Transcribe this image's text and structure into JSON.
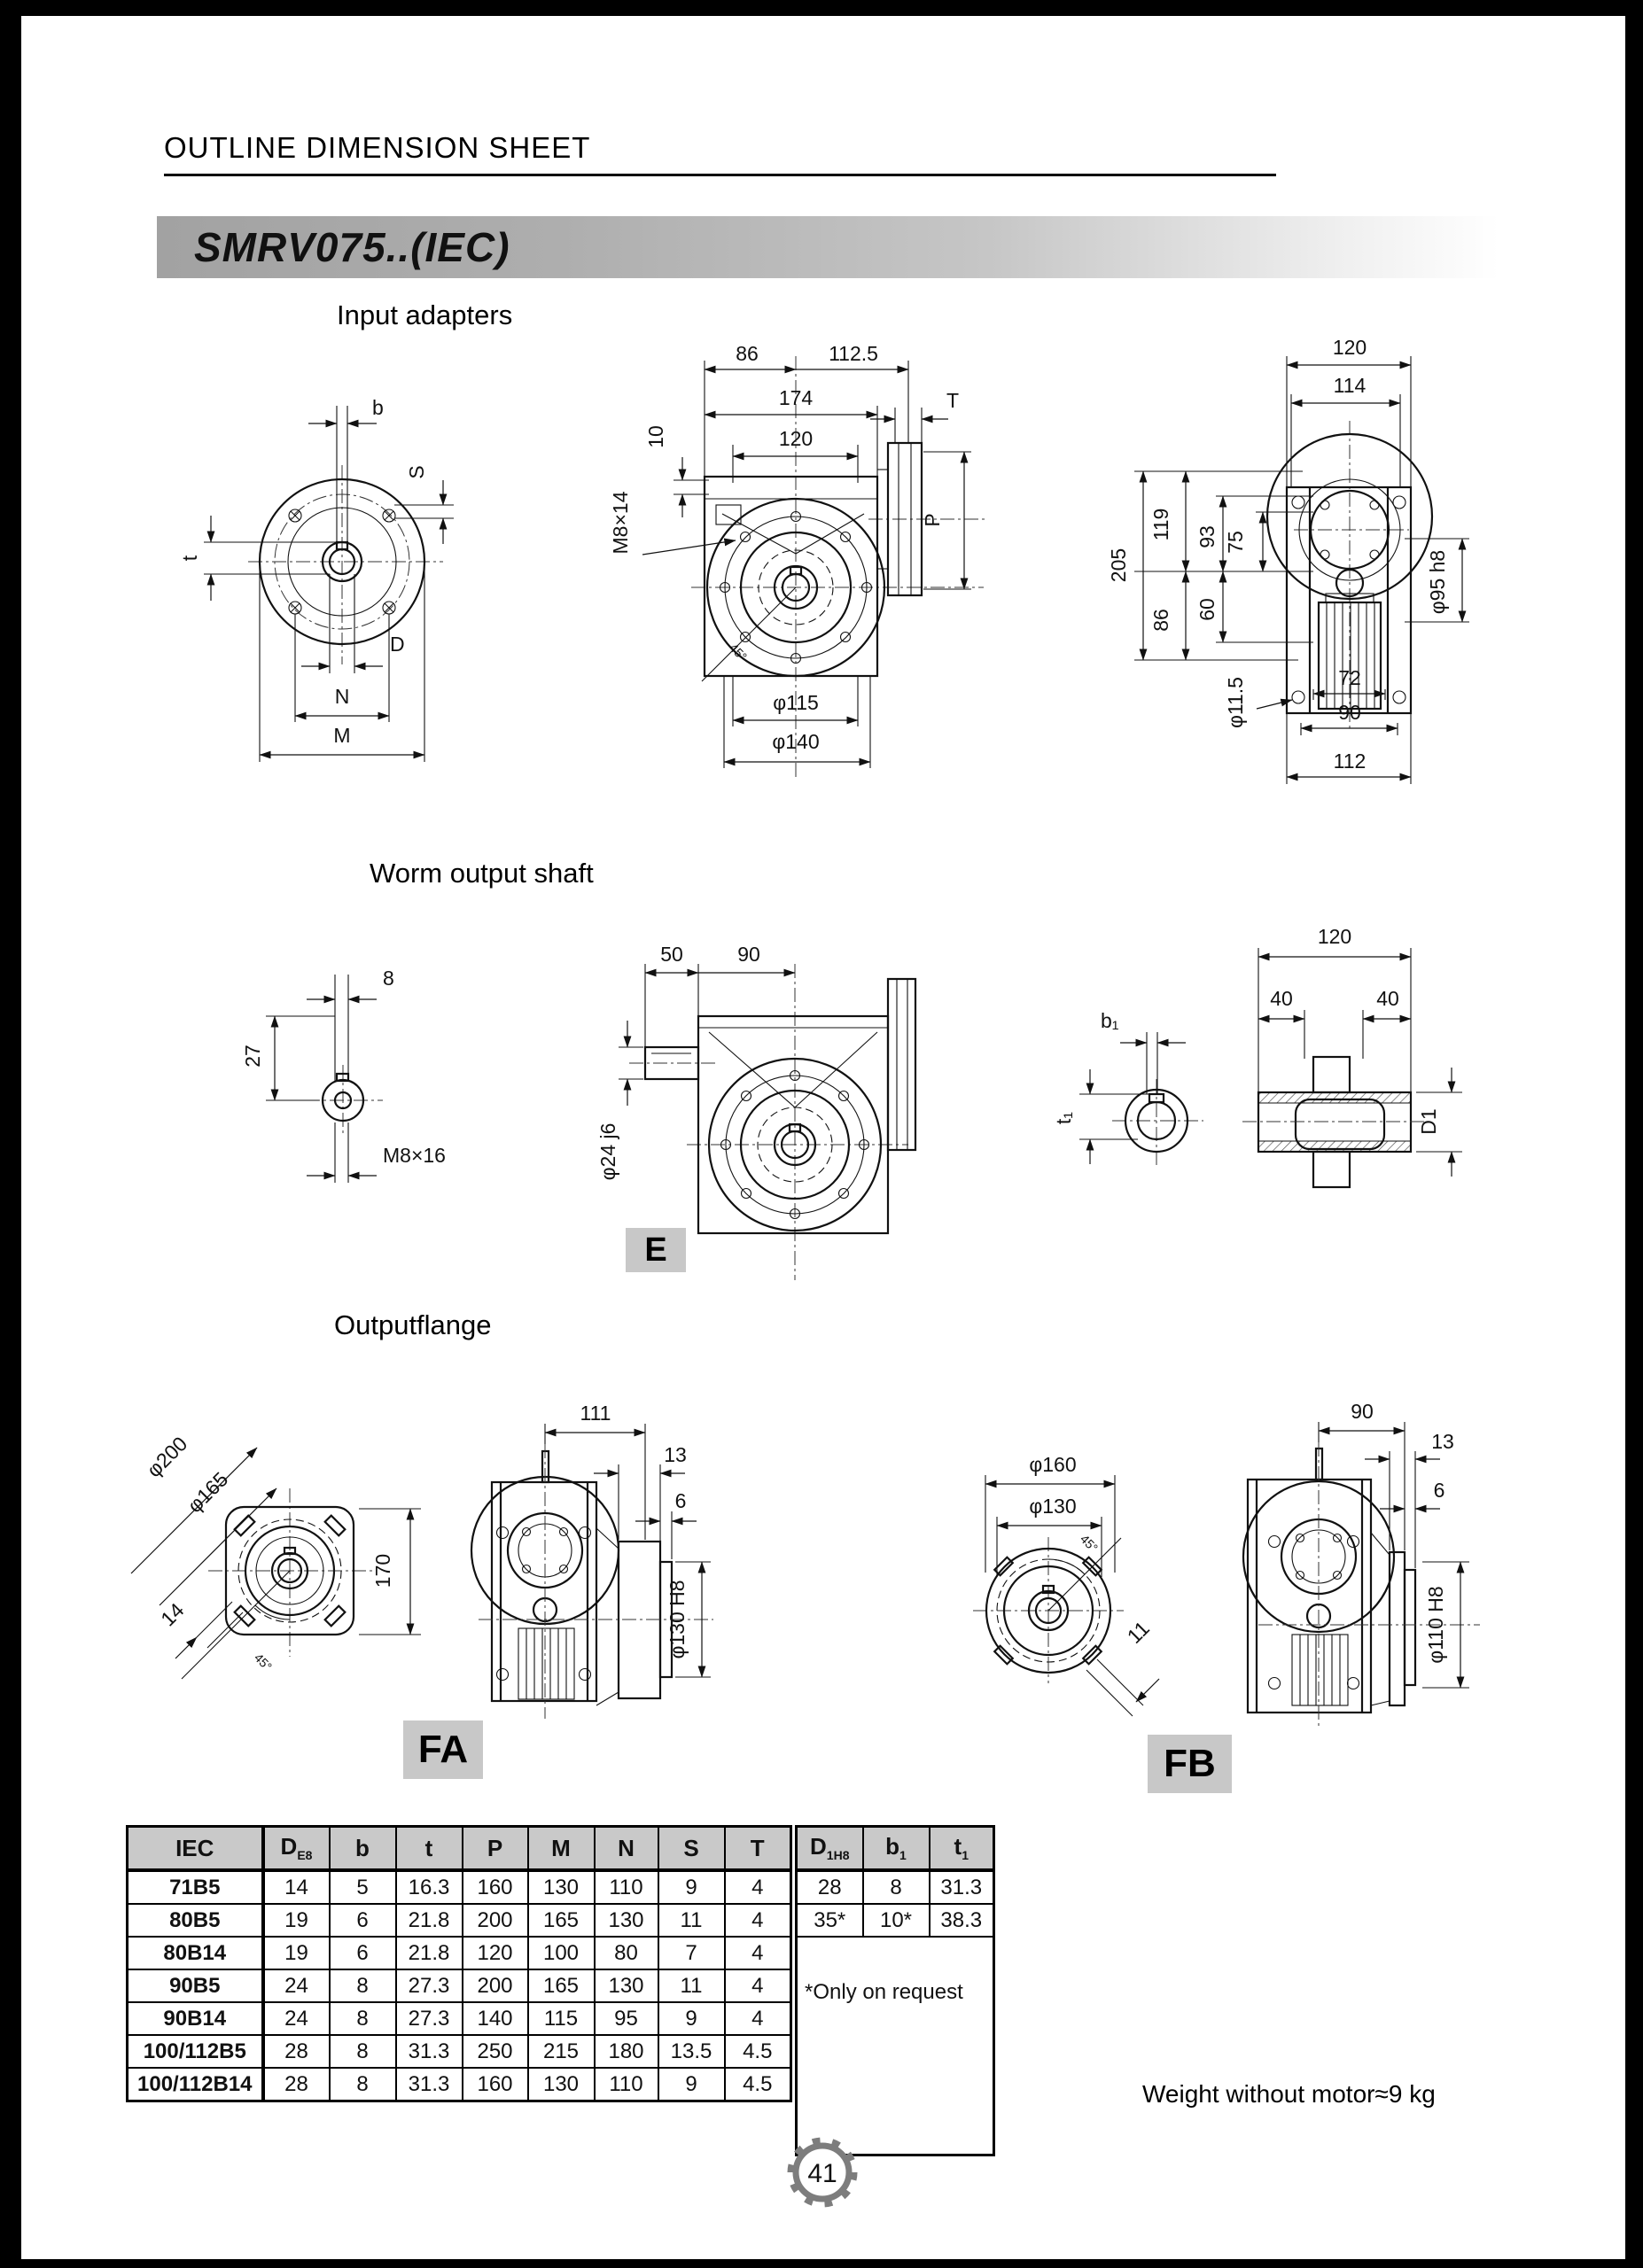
{
  "page": {
    "header_title": "OUTLINE DIMENSION SHEET",
    "model_title": "SMRV075..(IEC)",
    "weight_note": "Weight without motor≈9 kg",
    "page_number": "41"
  },
  "sections": {
    "input_adapters": "Input adapters",
    "worm_output_shaft": "Worm output shaft",
    "output_flange": "Outputflange"
  },
  "view_labels": {
    "e": "E",
    "fa": "FA",
    "fb": "FB"
  },
  "drawings": {
    "input_front": {
      "b": "b",
      "s": "S",
      "t": "t",
      "d": "D",
      "n": "N",
      "m": "M"
    },
    "input_side": {
      "d86": "86",
      "d112_5": "112.5",
      "d174": "174",
      "d120": "120",
      "d10": "10",
      "bolt": "M8×14",
      "t": "T",
      "p": "P",
      "d115": "φ115",
      "d140": "φ140",
      "angle": "45°"
    },
    "input_back": {
      "d120": "120",
      "d114": "114",
      "d205": "205",
      "d119": "119",
      "d93": "93",
      "d75": "75",
      "d86": "86",
      "d60": "60",
      "d95": "φ95 h8",
      "d11_5": "φ11.5",
      "d72": "72",
      "d90": "90",
      "d112": "112"
    },
    "worm_front": {
      "d8": "8",
      "d27": "27",
      "bolt": "M8×16"
    },
    "worm_side": {
      "d50": "50",
      "d90": "90",
      "shaft": "φ24 j6"
    },
    "worm_hollow": {
      "b1": "b₁",
      "t1": "t₁",
      "d120": "120",
      "d40a": "40",
      "d40b": "40",
      "d1": "D1"
    },
    "fa_front": {
      "d200": "φ200",
      "d165": "φ165",
      "d170": "170",
      "d14": "14",
      "angle": "45°"
    },
    "fa_side": {
      "d111": "111",
      "d13": "13",
      "d6": "6",
      "bore": "φ130 H8"
    },
    "fb_front": {
      "d160": "φ160",
      "d130": "φ130",
      "d11": "11",
      "angle": "45°"
    },
    "fb_side": {
      "d90": "90",
      "d13": "13",
      "d6": "6",
      "bore": "φ110 H8"
    }
  },
  "table": {
    "col_iec": "IEC",
    "col_d": {
      "main": "D",
      "sub": "E8"
    },
    "col_b": "b",
    "col_t": "t",
    "col_p": "P",
    "col_m": "M",
    "col_n": "N",
    "col_s": "S",
    "col_tt": "T",
    "col_d1": {
      "main": "D",
      "sub": "1H8"
    },
    "col_b1": {
      "main": "b",
      "sub": "1"
    },
    "col_t1": {
      "main": "t",
      "sub": "1"
    },
    "rows": [
      {
        "iec": "71B5",
        "d": "14",
        "b": "5",
        "t": "16.3",
        "p": "160",
        "m": "130",
        "n": "110",
        "s": "9",
        "tt": "4"
      },
      {
        "iec": "80B5",
        "d": "19",
        "b": "6",
        "t": "21.8",
        "p": "200",
        "m": "165",
        "n": "130",
        "s": "11",
        "tt": "4"
      },
      {
        "iec": "80B14",
        "d": "19",
        "b": "6",
        "t": "21.8",
        "p": "120",
        "m": "100",
        "n": "80",
        "s": "7",
        "tt": "4"
      },
      {
        "iec": "90B5",
        "d": "24",
        "b": "8",
        "t": "27.3",
        "p": "200",
        "m": "165",
        "n": "130",
        "s": "11",
        "tt": "4"
      },
      {
        "iec": "90B14",
        "d": "24",
        "b": "8",
        "t": "27.3",
        "p": "140",
        "m": "115",
        "n": "95",
        "s": "9",
        "tt": "4"
      },
      {
        "iec": "100/112B5",
        "d": "28",
        "b": "8",
        "t": "31.3",
        "p": "250",
        "m": "215",
        "n": "180",
        "s": "13.5",
        "tt": "4.5"
      },
      {
        "iec": "100/112B14",
        "d": "28",
        "b": "8",
        "t": "31.3",
        "p": "160",
        "m": "130",
        "n": "110",
        "s": "9",
        "tt": "4.5"
      }
    ],
    "right_rows": [
      {
        "d1": "28",
        "b1": "8",
        "t1": "31.3"
      },
      {
        "d1": "35*",
        "b1": "10*",
        "t1": "38.3"
      }
    ],
    "note": "*Only on request"
  }
}
